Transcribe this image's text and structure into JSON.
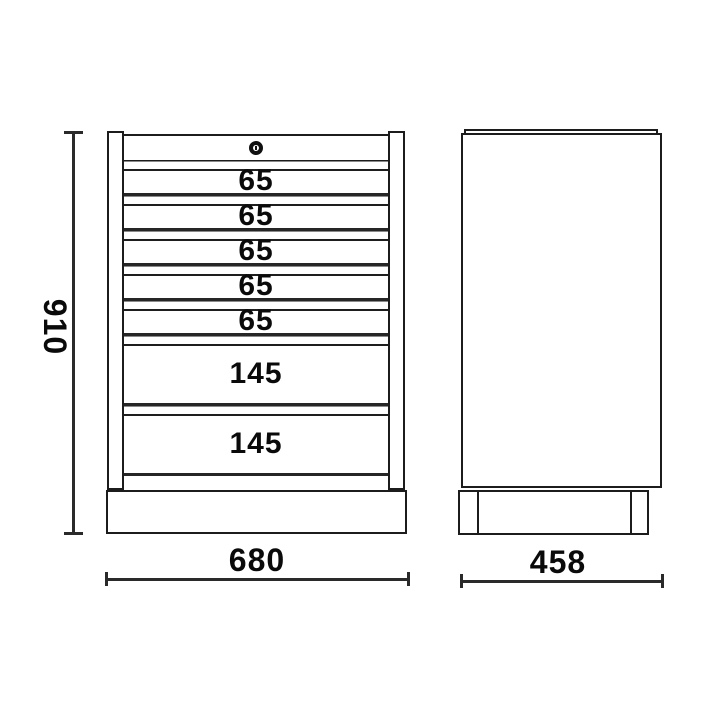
{
  "drawing": {
    "kind": "tool-cabinet-technical-drawing",
    "views": {
      "front": "front view with drawers",
      "side": "side view"
    }
  },
  "front_view": {
    "lock_icon": "keyhole-lock",
    "drawers": [
      {
        "label": "65"
      },
      {
        "label": "65"
      },
      {
        "label": "65"
      },
      {
        "label": "65"
      },
      {
        "label": "65"
      },
      {
        "label": "145"
      },
      {
        "label": "145"
      }
    ]
  },
  "dimensions": {
    "height_label": "910",
    "width_label": "680",
    "depth_label": "458"
  },
  "colors": {
    "background": "#ffffff",
    "line": "#1c1c1c",
    "text": "#0a0a0a"
  }
}
